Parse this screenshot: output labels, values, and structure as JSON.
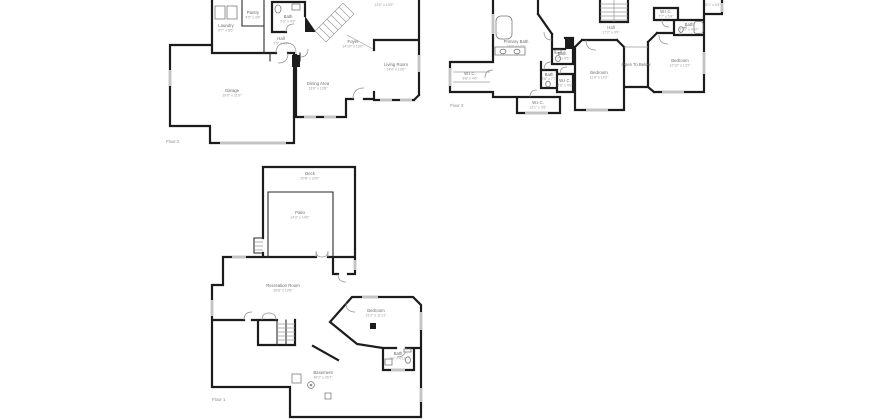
{
  "canvas": {
    "background": "#ffffff",
    "wall_color": "#1c1c1c",
    "window_color": "#c4c4c4",
    "room_label_color": "#6d6d6d",
    "dimension_label_color": "#9a9a9a"
  },
  "floor2": {
    "floor_label": "Floor 2",
    "rooms": {
      "laundry": {
        "name": "Laundry",
        "dims": "6'7\" x 5'6\""
      },
      "pantry": {
        "name": "Pantry",
        "dims": "4'5\" x 3'8\""
      },
      "bath": {
        "name": "Bath",
        "dims": "5'3\" x 4'9\""
      },
      "hall": {
        "name": "Hall",
        "dims": "7'5\" x 4'9\""
      },
      "foyer": {
        "name": "Foyer",
        "dims": "14'10\" x 13'0\""
      },
      "dining": {
        "name": "Dining Area",
        "dims": "13'6\" x 13'8\""
      },
      "living": {
        "name": "Living Room",
        "dims": "14'9\" x 13'0\""
      },
      "garage": {
        "name": "Garage",
        "dims": "29'0\" x 21'9\""
      },
      "cutoff_dims": "13'0\" x 13'9\""
    }
  },
  "floor3": {
    "floor_label": "Floor 3",
    "rooms": {
      "primary_bath": {
        "name": "Primary Bath",
        "dims": "13'9\" x 14'1\""
      },
      "wic_left": {
        "name": "W.I.C.",
        "dims": "9'8\" x 4'6\""
      },
      "hall": {
        "name": "Hall",
        "dims": "17'2\" x 9'9\""
      },
      "bath_center": {
        "name": "Bath",
        "dims": "7'7\" x 4'5\""
      },
      "bath_small": {
        "name": "Bath",
        "dims": "3'6\" x 7'7\""
      },
      "wic_small": {
        "name": "W.I.C.",
        "dims": "4'6\" x 4'9\""
      },
      "wic_bottom": {
        "name": "W.I.C.",
        "dims": "12'1\" x 3'6\""
      },
      "bedroom_center": {
        "name": "Bedroom",
        "dims": "11'9\" x 14'2\""
      },
      "open_to_below": {
        "name": "Open To Below"
      },
      "bedroom_right": {
        "name": "Bedroom",
        "dims": "12'10\" x 13'2\""
      },
      "wic_right": {
        "name": "W.I.C.",
        "dims": "7'7\" x 5'4\""
      },
      "bath_right": {
        "name": "Bath",
        "dims": "7'10\" x 4'10\""
      },
      "cutoff_dims": "5'1\" x 9'4\""
    }
  },
  "floor1": {
    "floor_label": "Floor 1",
    "rooms": {
      "deck": {
        "name": "Deck",
        "dims": "20'8\" x 20'0\""
      },
      "patio": {
        "name": "Patio",
        "dims": "14'2\" x 14'6\""
      },
      "recreation": {
        "name": "Recreation Room",
        "dims": "30'8\" x 19'8\""
      },
      "bedroom": {
        "name": "Bedroom",
        "dims": "21'2\" x 11'11\""
      },
      "bath": {
        "name": "Bath",
        "dims": "9'6\" x 4'11\""
      },
      "basement": {
        "name": "Basement",
        "dims": "48'2\" x 26'7\""
      }
    }
  }
}
